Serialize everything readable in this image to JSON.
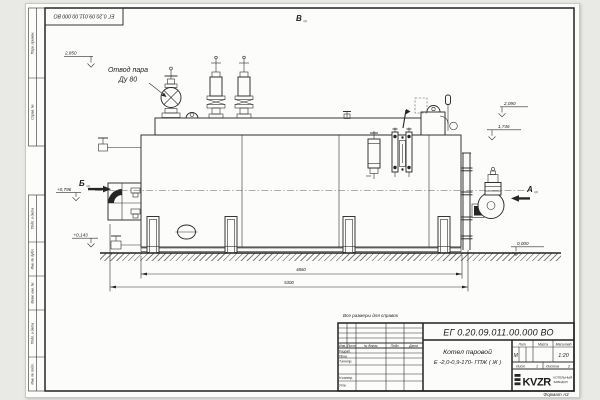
{
  "page": {
    "format_label": "Формат А3",
    "reference_note": "Все размеры для справок"
  },
  "top_stamp": {
    "doc_number": "ЕГ 0.20.09.011.00.000  ВО"
  },
  "margin_labels": [
    "Перв. примен.",
    "Справ. №",
    "Подп. и дата",
    "Инв. № дубл.",
    "Взам. инв. №",
    "Подп. и дата",
    "Инв. № подл."
  ],
  "drawing": {
    "callout_line1": "Отвод пара",
    "callout_line2": "Ду 80",
    "views": {
      "a": "А",
      "b": "Б",
      "v": "В",
      "sheet_ref": "(2)"
    },
    "elevations": {
      "e2850": "2,850",
      "e2090": "2,090",
      "e1746": "1,746",
      "e0796": "+0,796",
      "e0143": "+0,143",
      "e0000": "0,000"
    },
    "dimensions": {
      "d4860": "4860",
      "d5300": "5300"
    }
  },
  "title_block": {
    "doc_number": "ЕГ 0.20.09.011.00.000  ВО",
    "product_line1": "Котел паровой",
    "product_line2": "Е -2,0-0,9-170- ГПЖ ( Ж )",
    "rev_headers": {
      "izm": "Изм.",
      "list": "Лист",
      "doc": "№ докум.",
      "sign": "Подп.",
      "date": "Дата"
    },
    "roles": {
      "razrab": "Разраб.",
      "prov": "Пров.",
      "tkontr": "Т.контр.",
      "nkontr": "Н.контр.",
      "utv": "Утв."
    },
    "lit_header": "Лит.",
    "mass_header": "Масса",
    "scale_header": "Масштаб",
    "lit_value": "М",
    "scale_value": "1:20",
    "sheet_label": "Лист",
    "sheet_value": "1",
    "sheets_label": "Листов",
    "sheets_value": "2",
    "logo_text": "KVZR",
    "logo_sub1": "КОТЕЛЬНЫЙ",
    "logo_sub2": "ЗАВОД.РУ"
  }
}
